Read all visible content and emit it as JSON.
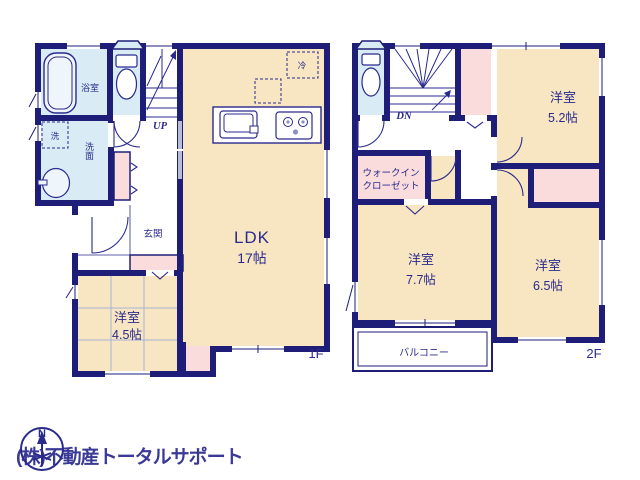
{
  "watermark": {
    "text": "(株)不動産トータルサポート"
  },
  "compass": {
    "north_label": "N"
  },
  "colors": {
    "wall": "#1e1e78",
    "room_cream": "#f7e6c1",
    "wet_blue": "#d9ecf6",
    "closet_pink": "#fadcdc",
    "label_navy": "#2a2a8e",
    "watermark_gray": "#c8c8c8",
    "sliding_door_gray": "#b7bcd8"
  },
  "floor1": {
    "floor_label": "1F",
    "stairs_label": "UP",
    "ldk": {
      "name": "LDK",
      "size": "17帖"
    },
    "western_room": {
      "name": "洋室",
      "size": "4.5帖"
    },
    "bath": {
      "name": "浴室"
    },
    "washroom": {
      "name": "洗面"
    },
    "laundry": {
      "name": "洗"
    },
    "fridge": {
      "name": "冷"
    },
    "entrance": {
      "name": "玄関"
    }
  },
  "floor2": {
    "floor_label": "2F",
    "stairs_label": "DN",
    "western_room_52": {
      "name": "洋室",
      "size": "5.2帖"
    },
    "western_room_77": {
      "name": "洋室",
      "size": "7.7帖"
    },
    "western_room_65": {
      "name": "洋室",
      "size": "6.5帖"
    },
    "walk_in_closet": {
      "line1": "ウォークイン",
      "line2": "クローゼット"
    },
    "balcony": {
      "name": "バルコニー"
    }
  }
}
